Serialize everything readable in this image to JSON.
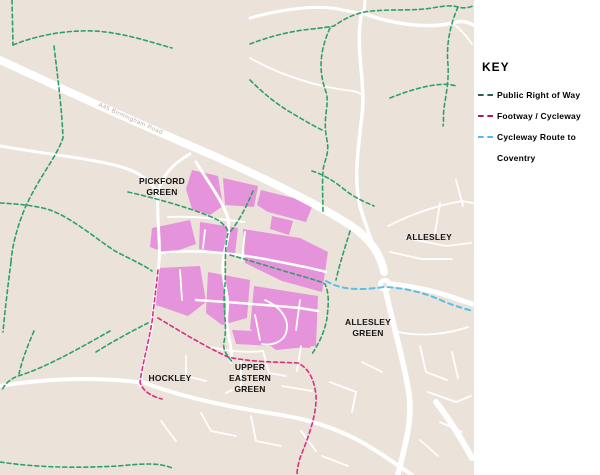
{
  "map": {
    "background_color": "#EBE2DA",
    "development_area_color": "#E593DB",
    "road_color": "#FFFFFF",
    "road_label": "A45 Birmingham Road",
    "place_labels": [
      {
        "lines": [
          "PICKFORD",
          "GREEN"
        ]
      },
      {
        "lines": [
          "ALLESLEY"
        ]
      },
      {
        "lines": [
          "ALLESLEY",
          "GREEN"
        ]
      },
      {
        "lines": [
          "HOCKLEY"
        ]
      },
      {
        "lines": [
          "UPPER",
          "EASTERN",
          "GREEN"
        ]
      }
    ],
    "path_colors": {
      "public_right_of_way": "#2FA06B",
      "footway_cycleway": "#D4317E",
      "cycleway_route_to_coventry": "#5BC0E8"
    }
  },
  "key": {
    "title": "KEY",
    "items": [
      {
        "label": "Public Right of Way",
        "swatch_color": "#2C5F4F"
      },
      {
        "label": "Footway / Cycleway",
        "swatch_color": "#9E2063"
      },
      {
        "label": "Cycleway Route to",
        "label_line2": "Coventry",
        "swatch_color": "#56B8E6"
      }
    ]
  }
}
